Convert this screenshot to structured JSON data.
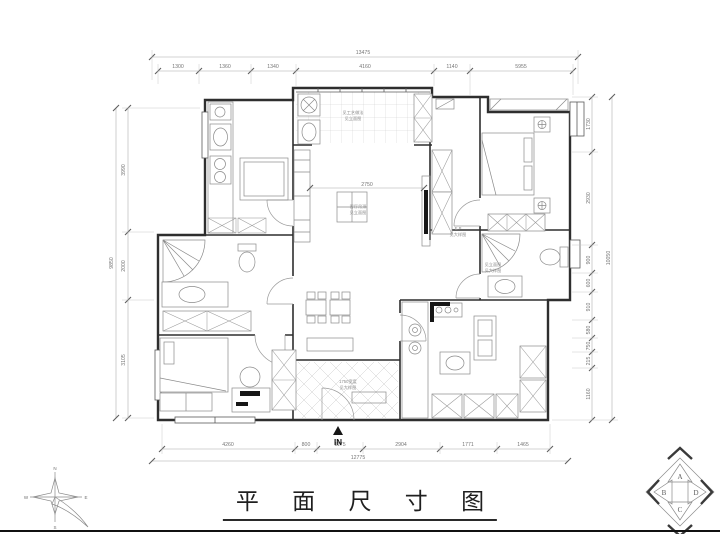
{
  "title": {
    "text": "平 面 尺 寸 图"
  },
  "entry_marker": {
    "label": "IN"
  },
  "compass": {
    "north": "N",
    "east": "E",
    "south": "S",
    "west": "W"
  },
  "logo": {
    "top": "A",
    "left": "B",
    "right": "D",
    "bottom": "C"
  },
  "colors": {
    "wall": "#2e2e2e",
    "dim_line": "#a8a8a8",
    "title_ink": "#1f1f1f"
  },
  "dims": {
    "top_total": "13475",
    "top_segments": [
      "1300",
      "1360",
      "1340",
      "4160",
      "1140",
      "5955"
    ],
    "bottom_segments": [
      "4260",
      "800",
      "1175",
      "2904",
      "1771",
      "1465"
    ],
    "bottom_total": "12775",
    "left_segments": [
      "3990",
      "2000",
      "3105"
    ],
    "left_total": "9850",
    "right_segments": [
      "1730",
      "2930",
      "900",
      "600",
      "910",
      "580",
      "750",
      "215",
      "1160"
    ],
    "right_total": "10050",
    "inner_living": "2750"
  },
  "annotations": {
    "balcony": {
      "line1": "见工艺做法",
      "line2": "见立面图"
    },
    "living": {
      "line1": "客厅吊顶",
      "line2": "见立面图"
    },
    "hall": {
      "line1": "E.P",
      "line2": "见大样图"
    },
    "bath": {
      "line1": "见立面图",
      "line2": "见大样图"
    },
    "entry": {
      "line1": "1750宽度",
      "line2": "见大样图"
    }
  }
}
